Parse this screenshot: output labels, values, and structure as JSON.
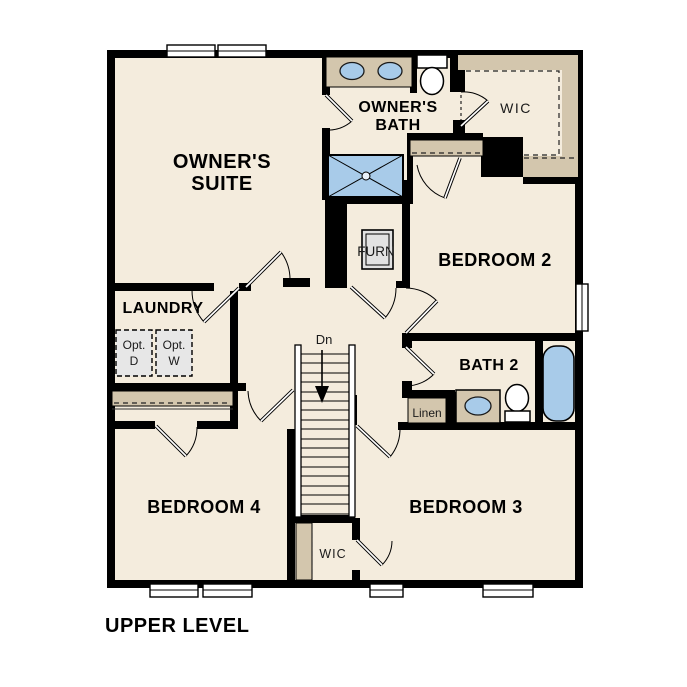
{
  "footer_label": "UPPER LEVEL",
  "colors": {
    "wall": "#000000",
    "floor": "#f4ecdd",
    "counter_tan": "#d3c6ad",
    "fixture_blue": "#a8cbe9",
    "option_gray": "#e7e7e7"
  },
  "rooms": {
    "owners_suite": {
      "line1": "OWNER'S",
      "line2": "SUITE"
    },
    "owners_bath": {
      "line1": "OWNER'S",
      "line2": "BATH"
    },
    "wic_top": {
      "label": "WIC"
    },
    "bedroom2": {
      "label": "BEDROOM 2"
    },
    "bath2": {
      "label": "BATH 2"
    },
    "linen": {
      "label": "Linen"
    },
    "laundry": {
      "label": "LAUNDRY"
    },
    "opt_dryer": {
      "line1": "Opt.",
      "line2": "D"
    },
    "opt_washer": {
      "line1": "Opt.",
      "line2": "W"
    },
    "furnace": {
      "label": "FURN"
    },
    "stairs": {
      "label": "Dn"
    },
    "bedroom3": {
      "label": "BEDROOM 3"
    },
    "bedroom4": {
      "label": "BEDROOM 4"
    },
    "wic_bottom": {
      "label": "WIC"
    }
  },
  "fixtures": {
    "double_vanity": "double-sink-vanity",
    "toilet_owners": "toilet",
    "shower": "walk-in-shower",
    "tub": "bathtub",
    "sink_bath2": "sink-vanity",
    "toilet_bath2": "toilet",
    "furnace_unit": "furnace-unit",
    "washer_dryer": "optional-washer-dryer"
  }
}
